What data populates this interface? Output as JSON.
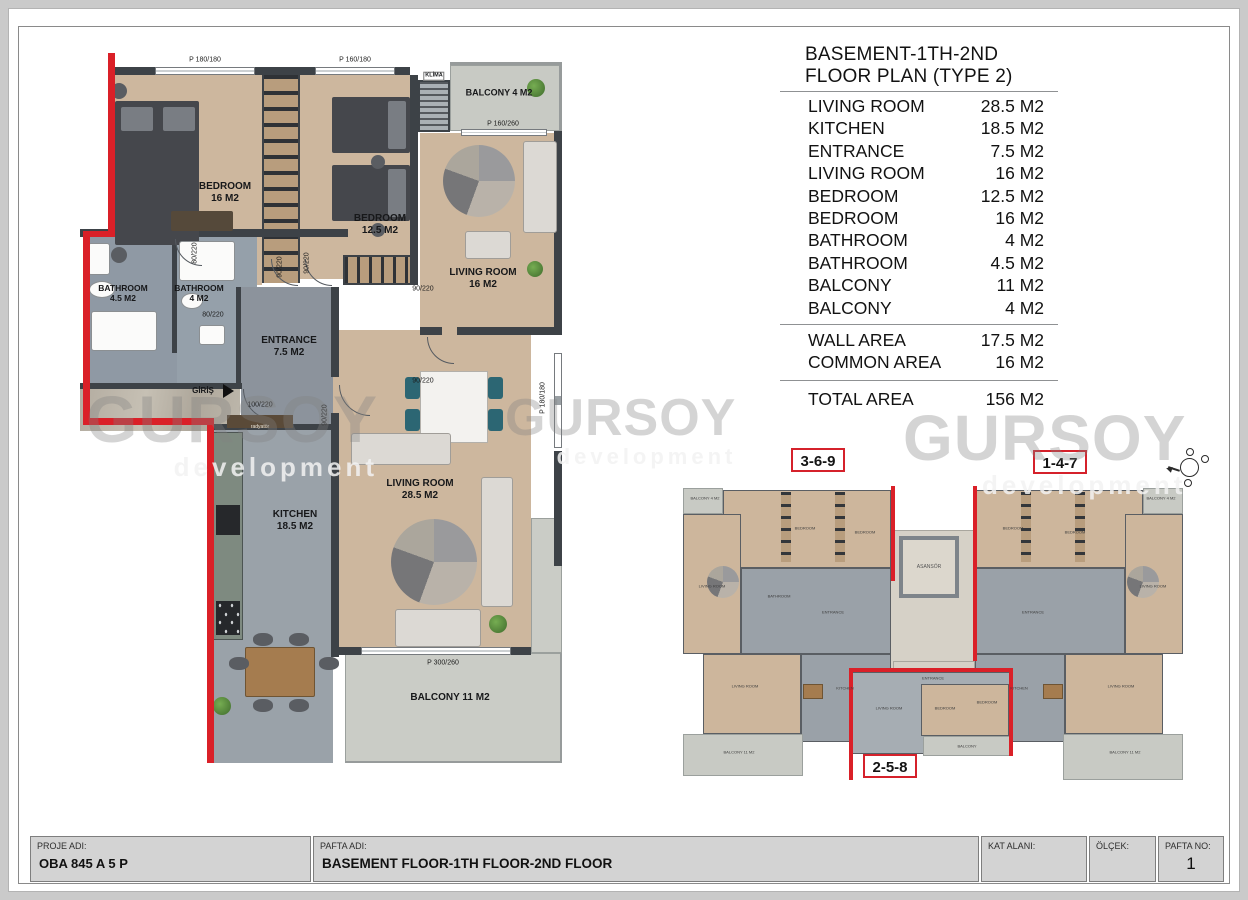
{
  "page": {
    "title_block": {
      "proje_adi_label": "PROJE ADI:",
      "proje_adi_value": "OBA 845 A 5 P",
      "pafta_adi_label": "PAFTA ADI:",
      "pafta_adi_value": "BASEMENT FLOOR-1TH FLOOR-2ND FLOOR",
      "kat_alani_label": "KAT ALANI:",
      "olcek_label": "ÖLÇEK:",
      "pafta_no_label": "PAFTA NO:",
      "pafta_no_value": "1"
    },
    "watermark": {
      "text": "GURSOY",
      "subtext": "development"
    }
  },
  "area_table": {
    "title_line1": "BASEMENT-1TH-2ND",
    "title_line2": "FLOOR PLAN (TYPE 2)",
    "rows": [
      {
        "name": "LIVING ROOM",
        "area": "28.5 M2"
      },
      {
        "name": "KITCHEN",
        "area": "18.5 M2"
      },
      {
        "name": "ENTRANCE",
        "area": "7.5 M2"
      },
      {
        "name": "LIVING ROOM",
        "area": "16 M2"
      },
      {
        "name": "BEDROOM",
        "area": "12.5 M2"
      },
      {
        "name": "BEDROOM",
        "area": "16 M2"
      },
      {
        "name": "BATHROOM",
        "area": "4 M2"
      },
      {
        "name": "BATHROOM",
        "area": "4.5 M2"
      },
      {
        "name": "BALCONY",
        "area": "11 M2"
      },
      {
        "name": "BALCONY",
        "area": "4 M2"
      }
    ],
    "summary_rows": [
      {
        "name": "WALL AREA",
        "area": "17.5 M2"
      },
      {
        "name": "COMMON AREA",
        "area": "16 M2"
      }
    ],
    "total_row": {
      "name": "TOTAL AREA",
      "area": "156 M2"
    }
  },
  "main_plan": {
    "rooms": {
      "bedroom_large": {
        "name": "BEDROOM",
        "area": "16 M2"
      },
      "bedroom_small": {
        "name": "BEDROOM",
        "area": "12.5 M2"
      },
      "living_small": {
        "name": "LIVING ROOM",
        "area": "16 M2"
      },
      "living_large": {
        "name": "LIVING ROOM",
        "area": "28.5 M2"
      },
      "kitchen": {
        "name": "KITCHEN",
        "area": "18.5 M2"
      },
      "entrance": {
        "name": "ENTRANCE",
        "area": "7.5 M2"
      },
      "bathroom_large": {
        "name": "BATHROOM",
        "area": "4.5 M2"
      },
      "bathroom_small": {
        "name": "BATHROOM",
        "area": "4 M2"
      },
      "balcony_small": "BALCONY 4 M2",
      "balcony_large": "BALCONY 11 M2"
    },
    "annotations": {
      "klima": "KLİMA",
      "giris": "GİRİŞ",
      "radiator": "radyatör"
    },
    "dimensions": {
      "window_180_180": "P 180/180",
      "window_160_180": "P 160/180",
      "window_160_260": "P 160/260",
      "window_300_260": "P 300/260",
      "door_80_220": "80/220",
      "door_90_220": "90/220",
      "door_100_220": "100/220"
    }
  },
  "overview_plan": {
    "unit_badges": [
      "3-6-9",
      "1-4-7",
      "2-5-8"
    ],
    "elevator_label": "ASANSÖR",
    "room_names": {
      "bedroom": "BEDROOM",
      "living": "LIVING ROOM",
      "kitchen": "KITCHEN",
      "entrance": "ENTRANCE",
      "bathroom": "BATHROOM",
      "balcony_11": "BALCONY 11 M2",
      "balcony_4": "BALCONY 4 M2",
      "balcony": "BALCONY"
    }
  }
}
